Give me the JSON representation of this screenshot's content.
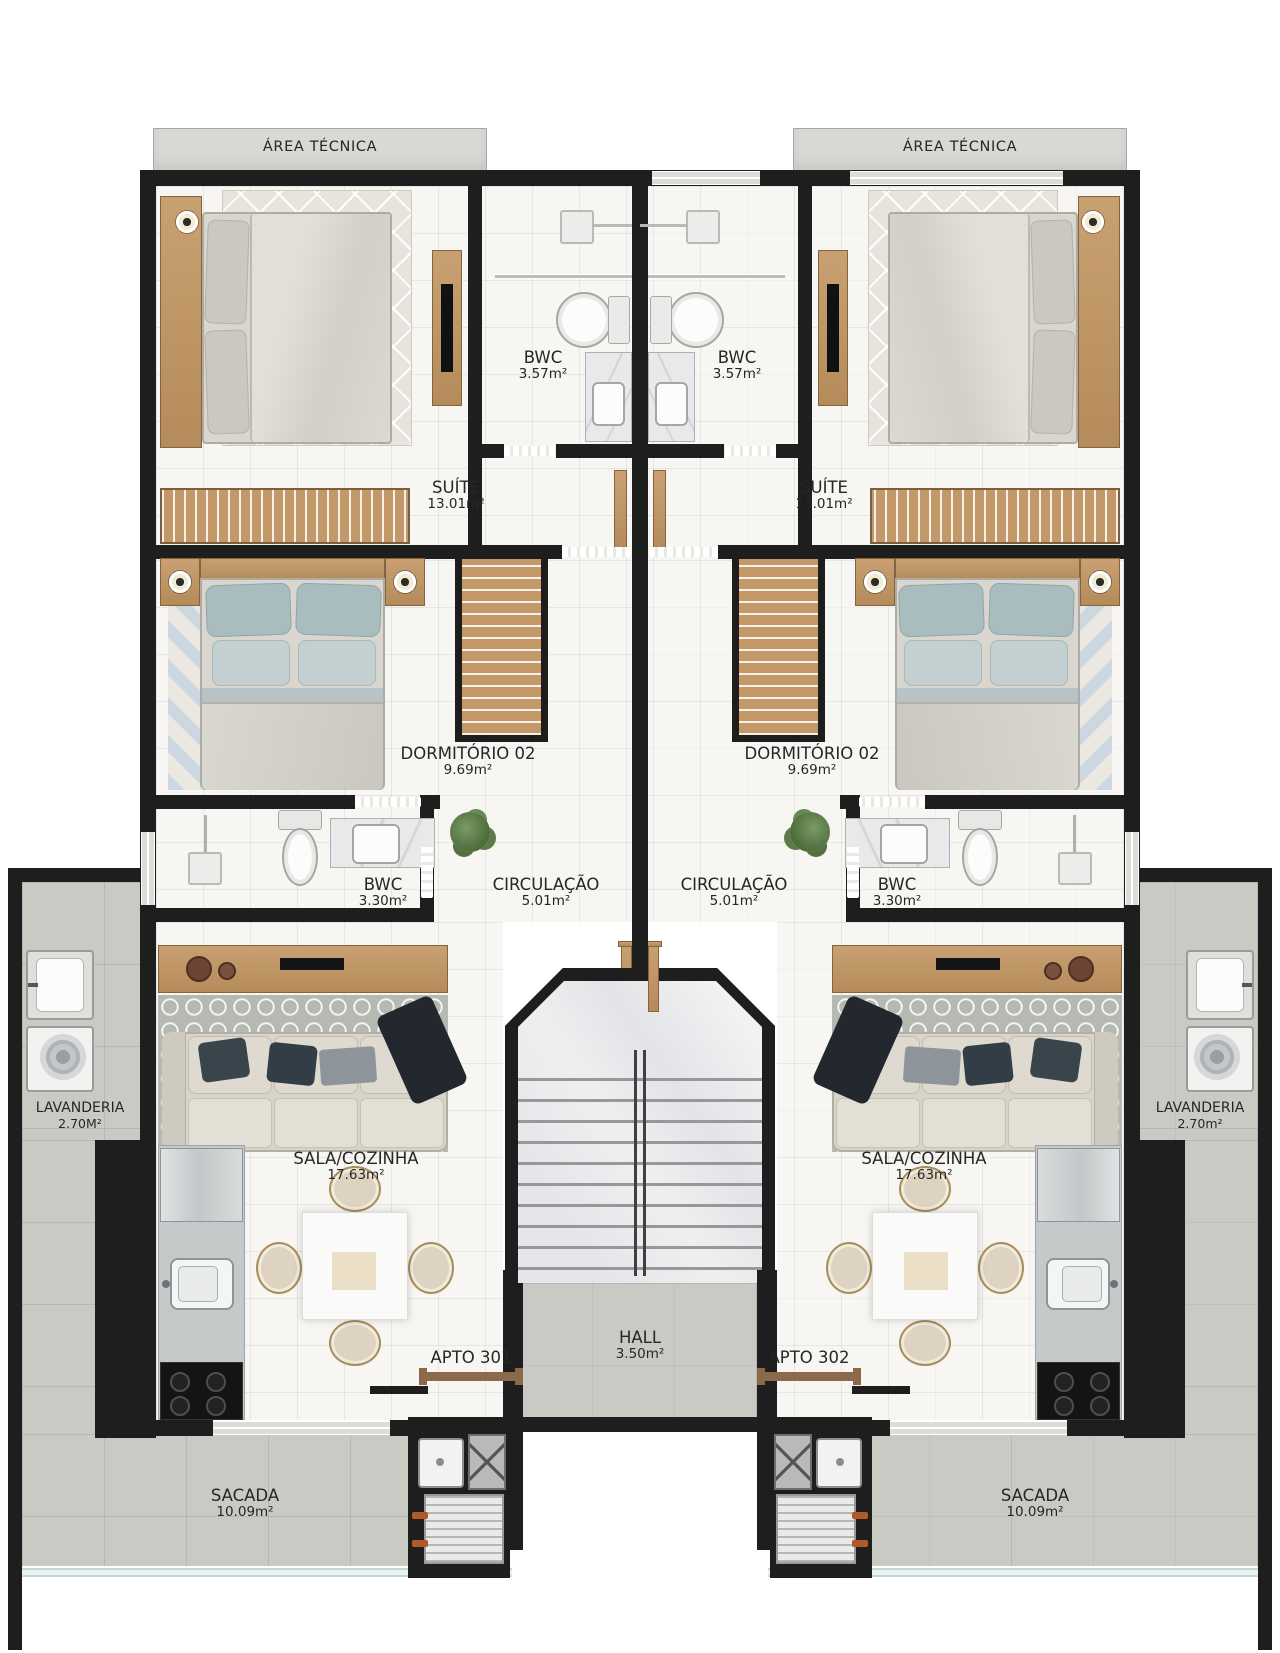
{
  "plan_title": "APTO 301 / APTO 302 floor plan",
  "rooms": {
    "area_tecnica_left": {
      "name": "ÁREA TÉCNICA"
    },
    "area_tecnica_right": {
      "name": "ÁREA TÉCNICA"
    },
    "bwc_suite_left": {
      "name": "BWC",
      "area": "3.57m²"
    },
    "bwc_suite_right": {
      "name": "BWC",
      "area": "3.57m²"
    },
    "suite_left": {
      "name": "SUÍTE",
      "area": "13.01m²"
    },
    "suite_right": {
      "name": "SUÍTE",
      "area": "13.01m²"
    },
    "dormitorio_left": {
      "name": "DORMITÓRIO 02",
      "area": "9.69m²"
    },
    "dormitorio_right": {
      "name": "DORMITÓRIO 02",
      "area": "9.69m²"
    },
    "bwc_social_left": {
      "name": "BWC",
      "area": "3.30m²"
    },
    "bwc_social_right": {
      "name": "BWC",
      "area": "3.30m²"
    },
    "circulacao_left": {
      "name": "CIRCULAÇÃO",
      "area": "5.01m²"
    },
    "circulacao_right": {
      "name": "CIRCULAÇÃO",
      "area": "5.01m²"
    },
    "lavanderia_left": {
      "name": "LAVANDERIA",
      "area": "2.70M²"
    },
    "lavanderia_right": {
      "name": "LAVANDERIA",
      "area": "2.70m²"
    },
    "sala_left": {
      "name": "SALA/COZINHA",
      "area": "17.63m²"
    },
    "sala_right": {
      "name": "SALA/COZINHA",
      "area": "17.63m²"
    },
    "apto_left": {
      "name": "APTO 301"
    },
    "apto_right": {
      "name": "APTO 302"
    },
    "hall": {
      "name": "HALL",
      "area": "3.50m²"
    },
    "sacada_left": {
      "name": "SACADA",
      "area": "10.09m²"
    },
    "sacada_right": {
      "name": "SACADA",
      "area": "10.09m²"
    }
  },
  "palette": {
    "wall": "#1e1e1e",
    "floor_light": "#f7f6f3",
    "floor_gray": "#c9cac3",
    "area_tecnica_bg": "#d9d8d4",
    "wood": "#bf9768",
    "marble": "#eaeaec",
    "bed_linen": "#d9d6d0",
    "pillow_blue": "#a9bdbf",
    "sofa": "#d8d4ca",
    "pillow_dark": "#39444c",
    "glass_rail": "#bcd9db",
    "grill_handle": "#b05a28",
    "door_wood": "#8a6a4a",
    "text": "#262626"
  }
}
